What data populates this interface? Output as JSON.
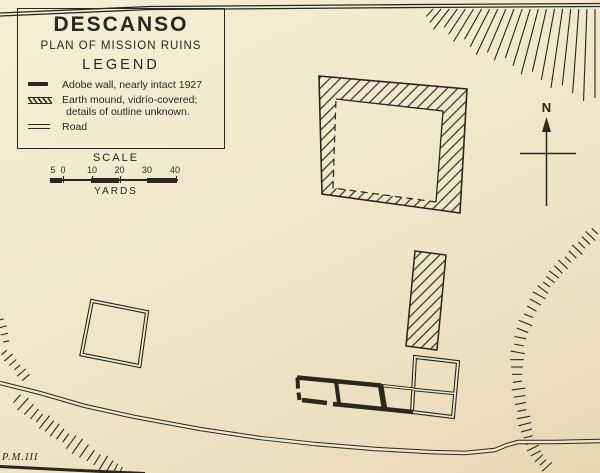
{
  "map": {
    "title": "DESCANSO",
    "subtitle": "PLAN OF MISSION RUINS",
    "legend": {
      "heading": "LEGEND",
      "items": [
        {
          "icon": "adobe-wall-symbol",
          "label": "Adobe wall, nearly intact 1927"
        },
        {
          "icon": "earth-mound-symbol",
          "label": "Earth mound, vidrío-covered; details of outline unknown."
        },
        {
          "icon": "road-symbol",
          "label": "Road"
        }
      ]
    },
    "scale": {
      "heading": "SCALE",
      "unit": "YARDS",
      "tick_labels": [
        "5",
        "0",
        "10",
        "20",
        "30",
        "40"
      ]
    },
    "compass": {
      "north_label": "N"
    },
    "annotation": "P.M.III",
    "colors": {
      "paper": "#f2e7cc",
      "ink": "#2b261e"
    }
  }
}
